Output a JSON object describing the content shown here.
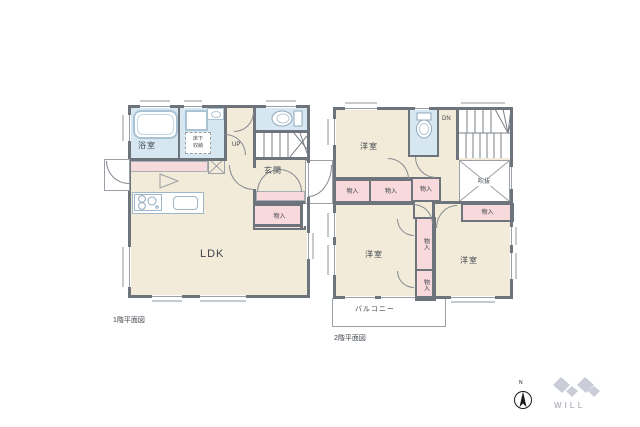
{
  "floor1": {
    "caption": "1階平面図",
    "bathroom_label": "浴室",
    "underfloor_line1": "床下",
    "underfloor_line2": "収納",
    "stairs_label": "UP",
    "entrance_label": "玄関",
    "closet_label": "物入",
    "ldk_label": "LDK"
  },
  "floor2": {
    "caption": "2階平面図",
    "bedroom1_label": "洋室",
    "bedroom2_label": "洋室",
    "bedroom3_label": "洋室",
    "stairs_label": "DN",
    "void_label": "吹抜",
    "closet1_label": "物入",
    "closet2_label": "物入",
    "closet3_label": "物入",
    "closet4_label": "物入",
    "closet5_label": "物入",
    "closet6_label": "物入",
    "balcony_label": "バルコニー"
  },
  "compass": {
    "north_label": "N"
  },
  "logo": {
    "text": "WILL"
  },
  "colors": {
    "wall": "#6e747b",
    "room_fill": "#f3ebd9",
    "wet_area_fill": "#d7e7f1",
    "closet_fill": "#f8dadd",
    "outline_gray": "#9aa0a5",
    "text": "#3f454c",
    "logo_gray": "#cacdd8"
  }
}
